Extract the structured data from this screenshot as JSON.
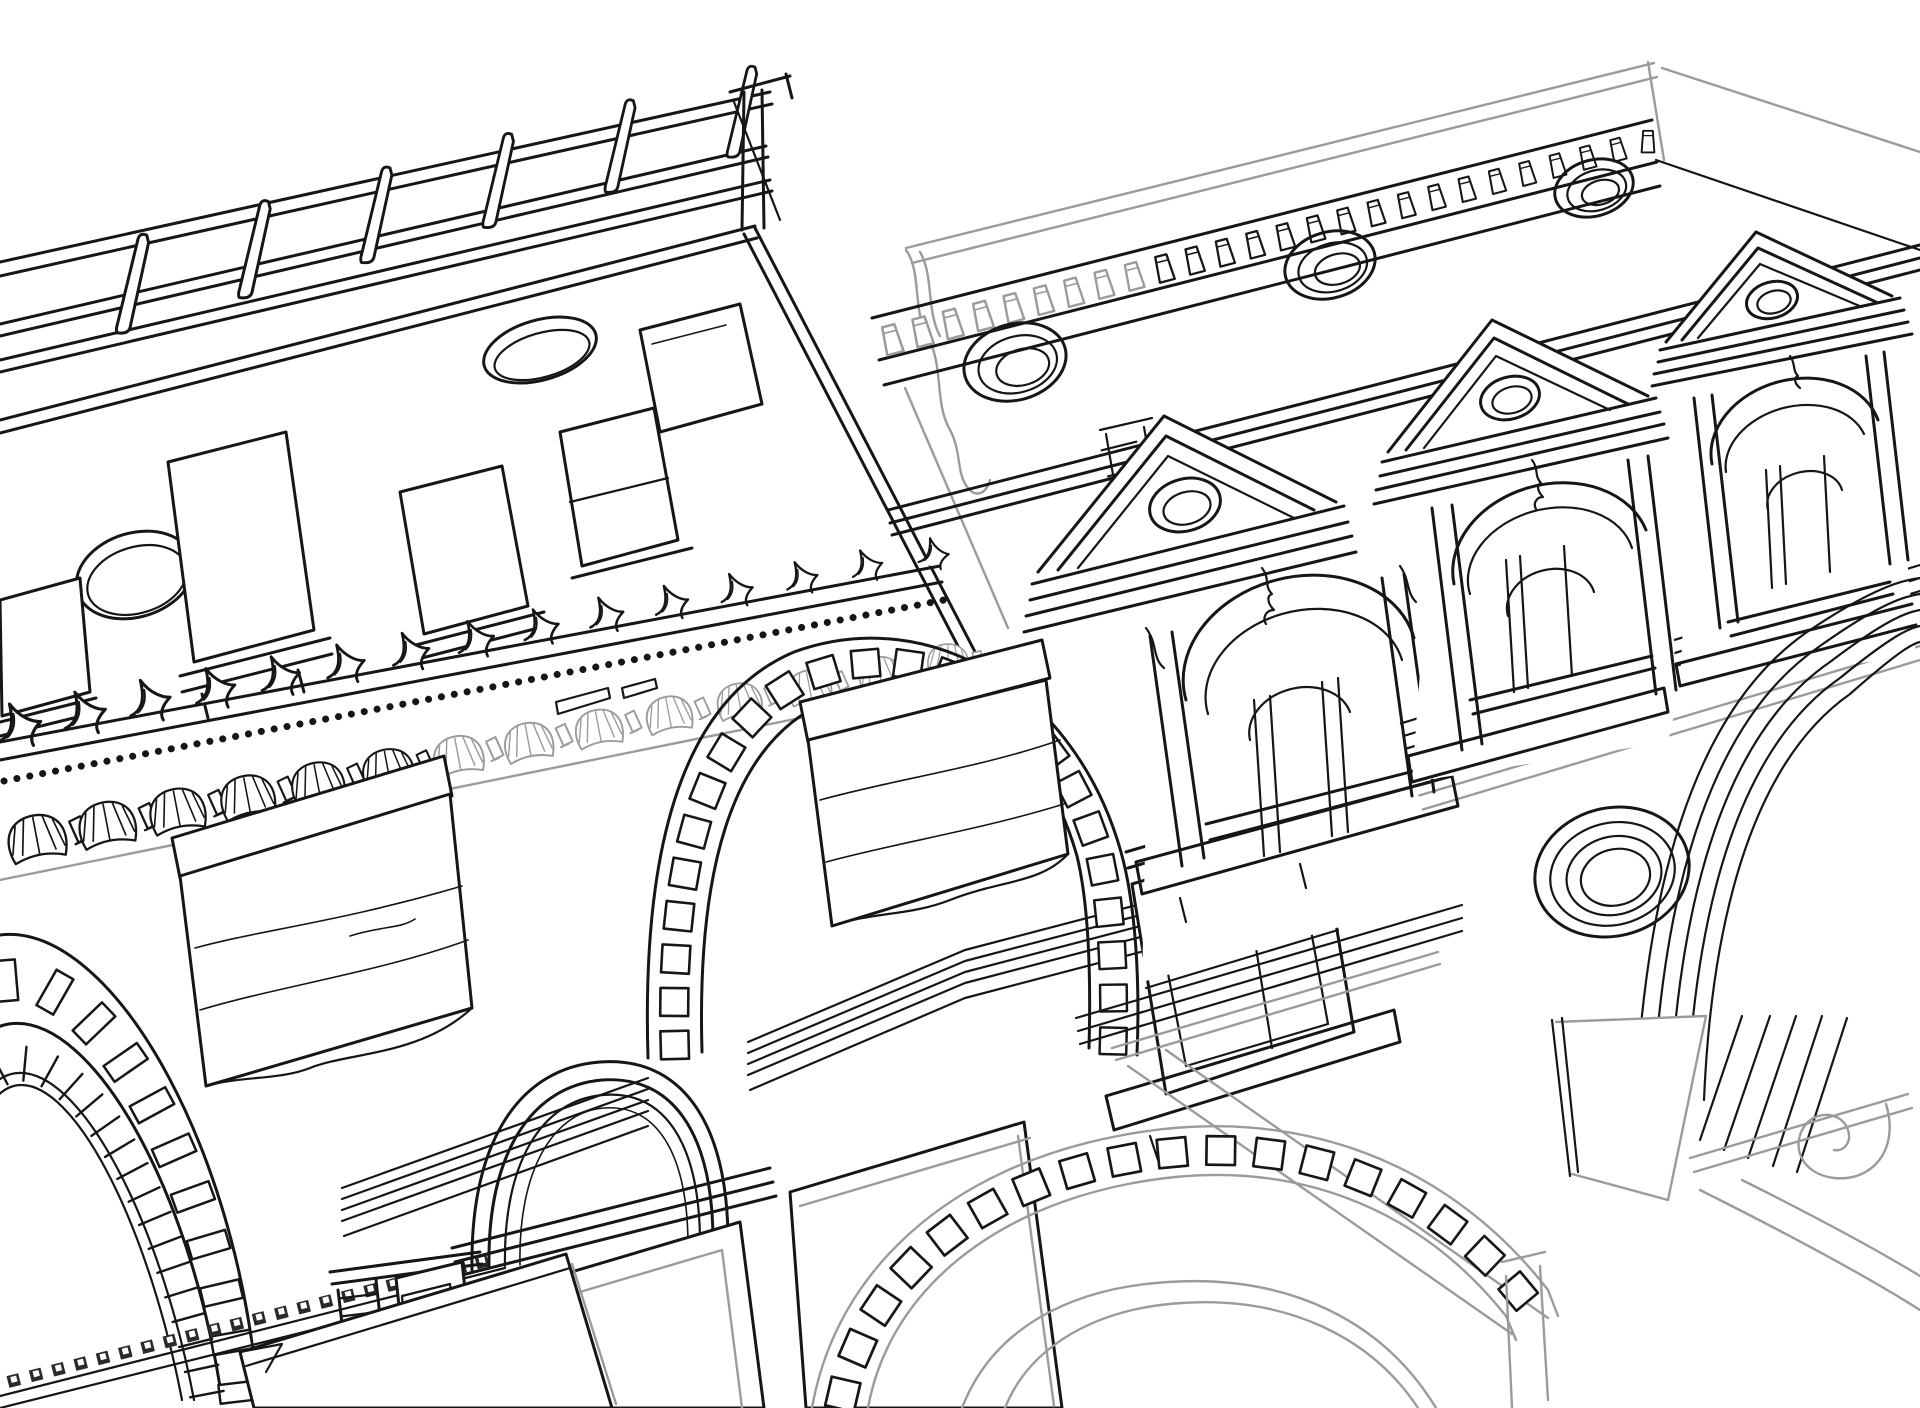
{
  "meta": {
    "title": "Architectural line drawing — two palazzo facades seen from below",
    "medium": "vector outline illustration, no text",
    "background": "#ffffff"
  },
  "palette": {
    "ink": "#161616",
    "muted_gray": "#9b9b9b",
    "paper": "#ffffff"
  },
  "scene": {
    "description": "Black-and-white outline drawing of two classical building facades viewed in steep perspective from below-left: a left palazzo with rooftop balustrade, scallop-shell cornice, attic windows, street-level brick arch, awnings and arched doorway; a right palazzo with dentil cornice, oculus frieze and three pedimented aedicula windows; a lower arcade with concentric arches, coffered archivolt, spandrel oculus and a volute capital at bottom right.",
    "elements": [
      {
        "id": "left-building",
        "label": "Left palazzo facade"
      },
      {
        "id": "balustrade",
        "label": "Rooftop balustrade with slanted posts"
      },
      {
        "id": "attic-windows",
        "label": "Attic windows and oval oculi"
      },
      {
        "id": "shell-cornice",
        "label": "Cornice with antefixes, bead molding and scallop-shell brackets"
      },
      {
        "id": "brick-arch",
        "label": "Street-level brick voussoir arch"
      },
      {
        "id": "awning-left",
        "label": "Left fabric awning"
      },
      {
        "id": "awning-center",
        "label": "Center fabric awning"
      },
      {
        "id": "doorway",
        "label": "Arched doorway with molded archivolt"
      },
      {
        "id": "coffered-arch",
        "label": "Wide coffered storefront arch"
      },
      {
        "id": "sash-window",
        "label": "Deep-set four-pane window with sill"
      },
      {
        "id": "sign-panels",
        "label": "Blank storefront panels"
      },
      {
        "id": "string-courses",
        "label": "Diagonal string-course moldings"
      },
      {
        "id": "right-building",
        "label": "Right palazzo facade"
      },
      {
        "id": "parapet",
        "label": "Gray parapet band with corner return"
      },
      {
        "id": "dentil-cornice",
        "label": "Dentil cornice"
      },
      {
        "id": "oculus-frieze",
        "label": "Frieze with three ring oculi"
      },
      {
        "id": "aediculae",
        "label": "Three pedimented arch windows with balconies"
      },
      {
        "id": "arcade",
        "label": "Lower arcade with concentric arches"
      },
      {
        "id": "spandrel-oculus",
        "label": "Four-ring spandrel oculus"
      },
      {
        "id": "capital",
        "label": "Volute capital with fluted shaft"
      }
    ]
  }
}
